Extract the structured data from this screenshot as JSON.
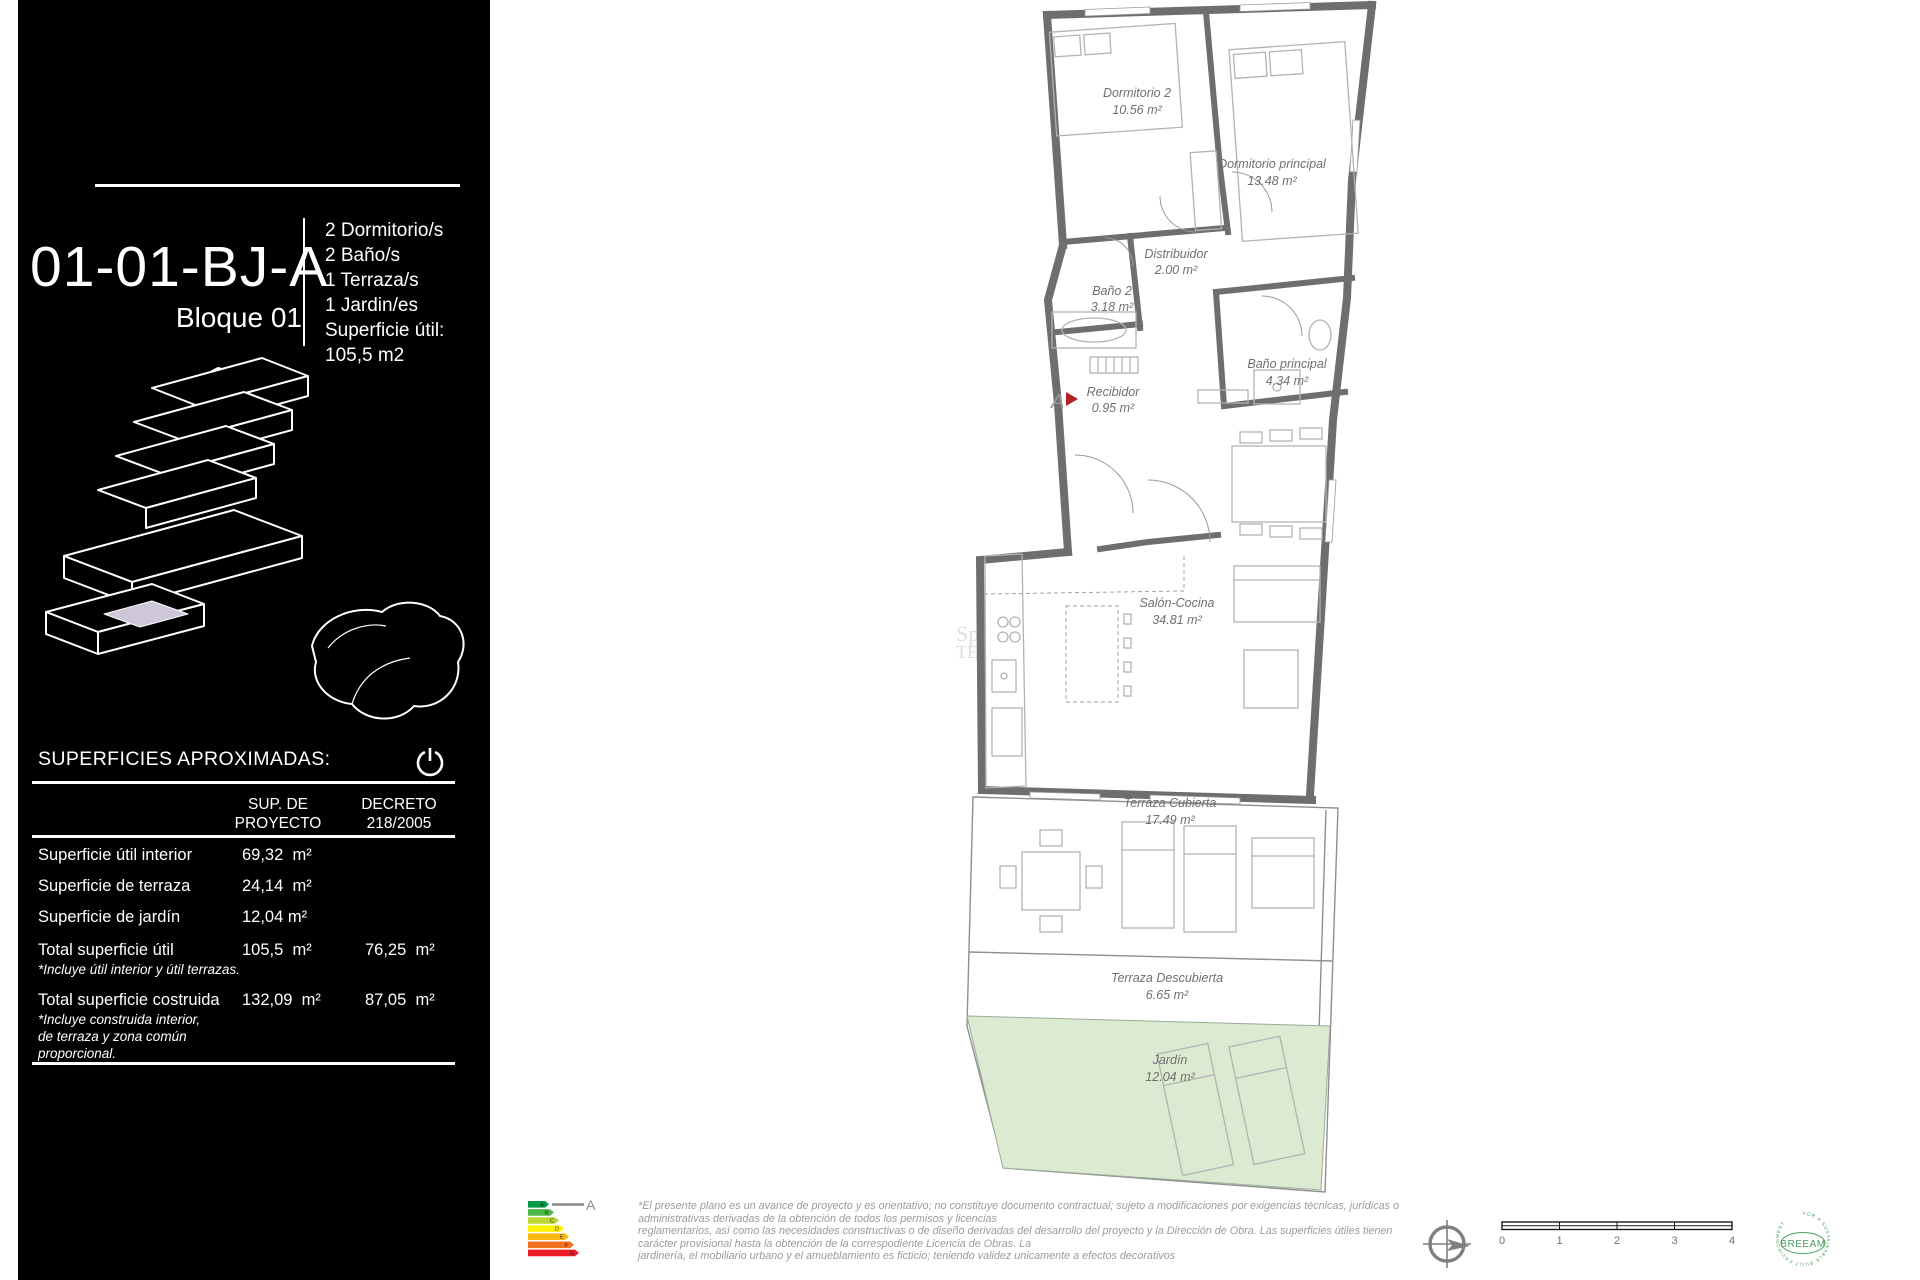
{
  "sidebar": {
    "unit_code": "01-01-BJ-A",
    "block_label": "Bloque 01",
    "features": [
      "2 Dormitorio/s",
      "2 Baño/s",
      "1 Terraza/s",
      "1 Jardin/es",
      "Superficie útil:",
      "105,5  m2"
    ],
    "surfaces_title": "SUPERFICIES APROXIMADAS:",
    "table": {
      "col1_header": "SUP. DE\nPROYECTO",
      "col2_header": "DECRETO\n218/2005",
      "rows": [
        {
          "label": "Superficie útil interior",
          "project": "69,32  m²",
          "decreto": ""
        },
        {
          "label": "Superficie de terraza",
          "project": "24,14  m²",
          "decreto": ""
        },
        {
          "label": "Superficie de jardín",
          "project": "12,04 m²",
          "decreto": ""
        },
        {
          "label": "Total superficie útil",
          "project": "105,5  m²",
          "decreto": "76,25  m²",
          "note": "*Incluye útil interior y útil terrazas."
        },
        {
          "label": "Total superficie costruida",
          "project": "132,09  m²",
          "decreto": "87,05  m²",
          "note1": "*Incluye construida interior,",
          "note2": "de terraza y zona común",
          "note3": "proporcional."
        }
      ]
    }
  },
  "plan": {
    "wall_color": "#6e6e6e",
    "garden_color": "#dcead2",
    "section_marker": "A",
    "watermark_line1": "Spo",
    "watermark_line2": "TE",
    "rooms": [
      {
        "name": "Dormitorio 2",
        "area": "10.56 m²"
      },
      {
        "name": "Dormitorio principal",
        "area": "13.48 m²"
      },
      {
        "name": "Baño 2",
        "area": "3.18 m²"
      },
      {
        "name": "Distribuidor",
        "area": "2.00 m²"
      },
      {
        "name": "Baño principal",
        "area": "4.34 m²"
      },
      {
        "name": "Recibidor",
        "area": "0.95 m²"
      },
      {
        "name": "Salón-Cocina",
        "area": "34.81 m²"
      },
      {
        "name": "Terraza Cubierta",
        "area": "17.49 m²"
      },
      {
        "name": "Terraza Descubierta",
        "area": "6.65 m²"
      },
      {
        "name": "Jardín",
        "area": "12.04 m²"
      }
    ]
  },
  "footer": {
    "disclaimer_lines": [
      "*El presente plano es un avance de proyecto y es orientativo; no constituye documento contractual; sujeto a modificaciones por exigencias técnicas, jurídicas o",
      "administrativas derivadas de la obtención de todos los permisos y licencias",
      "reglamentarios, así como las necesidades constructivas o de diseño derivadas del desarrollo del proyecto y la Dirección de Obra. Las superficies útiles tienen",
      "carácter provisional hasta la obtención de la correspodiente Licencia de Obras. La",
      "jardinería, el mobiliario urbano y el amueblamiento es ficticio; teniendo validez unicamente a efectos decorativos"
    ],
    "energy": {
      "rating": "A",
      "letters": [
        "A",
        "B",
        "C",
        "D",
        "E",
        "F",
        "G"
      ],
      "colors": [
        "#009a44",
        "#50b848",
        "#bed630",
        "#fff200",
        "#fdb913",
        "#f37021",
        "#ed1c24"
      ]
    },
    "scale_labels": [
      "0",
      "1",
      "2",
      "3",
      "4"
    ],
    "breeam": {
      "name": "BREEAM",
      "ring_text": "FOR A SUSTAINABLE BUILT ENVIRONMENT",
      "color": "#4a9e5c"
    }
  }
}
